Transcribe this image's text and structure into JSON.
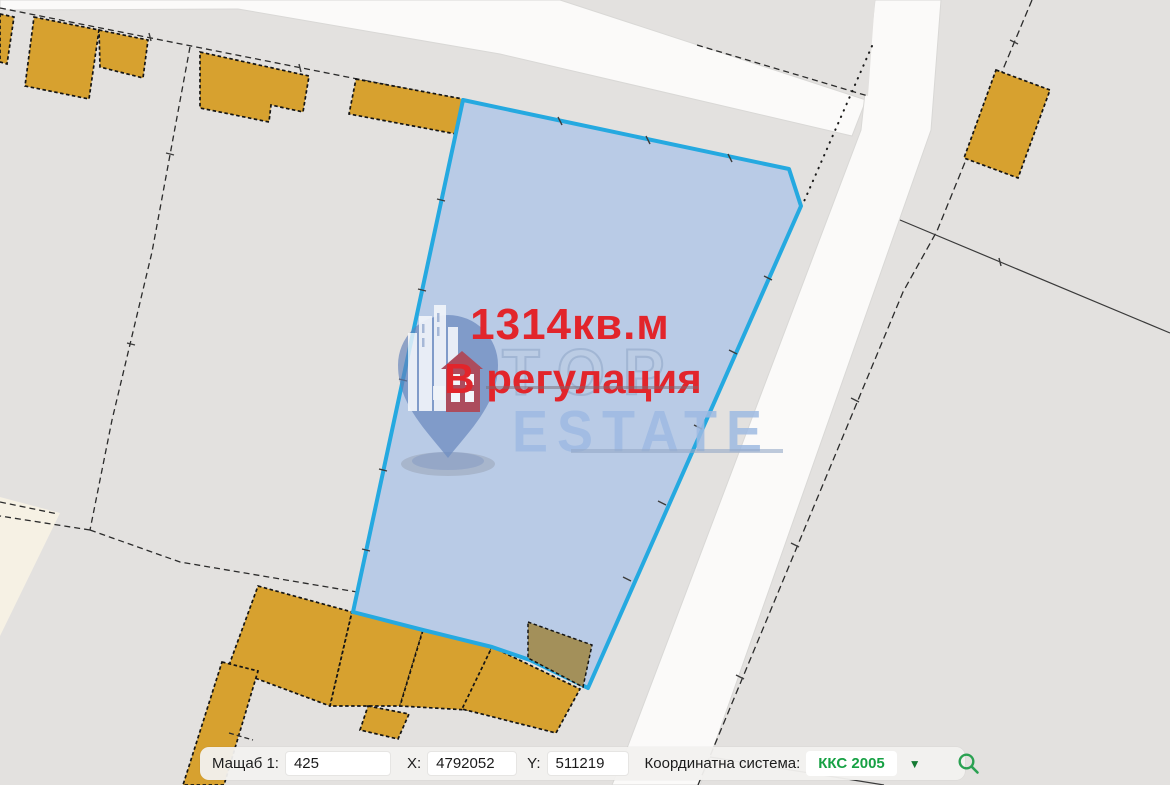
{
  "map": {
    "parcel": {
      "area_label": "1314кв.м",
      "status_label": "В регулация"
    },
    "watermark": {
      "line1": "TOP",
      "line2": "ESTATE"
    }
  },
  "toolbar": {
    "scale_label": "Мащаб 1:",
    "scale_value": "425",
    "x_label": "X:",
    "x_value": "4792052",
    "y_label": "Y:",
    "y_value": "511219",
    "crs_label": "Координатна система:",
    "crs_value": "ККС 2005",
    "dropdown_arrow": "▼"
  },
  "icons": {
    "search": "magnifier-icon",
    "dropdown": "chevron-down-icon"
  },
  "colors": {
    "background_gray": "#e3e1df",
    "road_white": "#fbfaf9",
    "parcel_fill": "#b6c9e6",
    "parcel_stroke": "#25a9e0",
    "building_fill": "#d7a12f",
    "olive_building_fill": "#a3905a",
    "cream_area": "#f6f1e4",
    "label_red": "#e2252b",
    "crs_green": "#17a144"
  }
}
